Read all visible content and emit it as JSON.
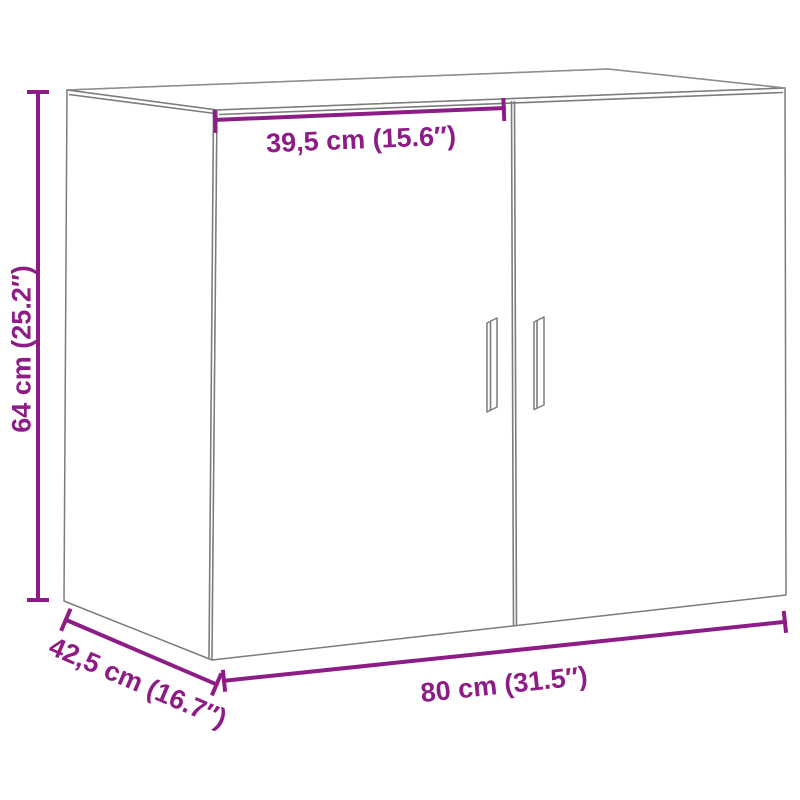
{
  "diagram": {
    "subject": "wall-cabinet-with-two-doors",
    "measurements": {
      "door_width": {
        "cm": "39,5",
        "inches": "15.6",
        "label": "39,5 cm (15.6″)"
      },
      "height": {
        "cm": "64",
        "inches": "25.2",
        "label": "64 cm (25.2″)"
      },
      "depth": {
        "cm": "42,5",
        "inches": "16.7",
        "label": "42,5 cm (16.7″)"
      },
      "width": {
        "cm": "80",
        "inches": "31.5",
        "label": "80 cm (31.5″)"
      }
    },
    "colors": {
      "accent_purple": "#8e1c86",
      "outline_gray": "#7c7c7c",
      "background": "#ffffff"
    }
  }
}
